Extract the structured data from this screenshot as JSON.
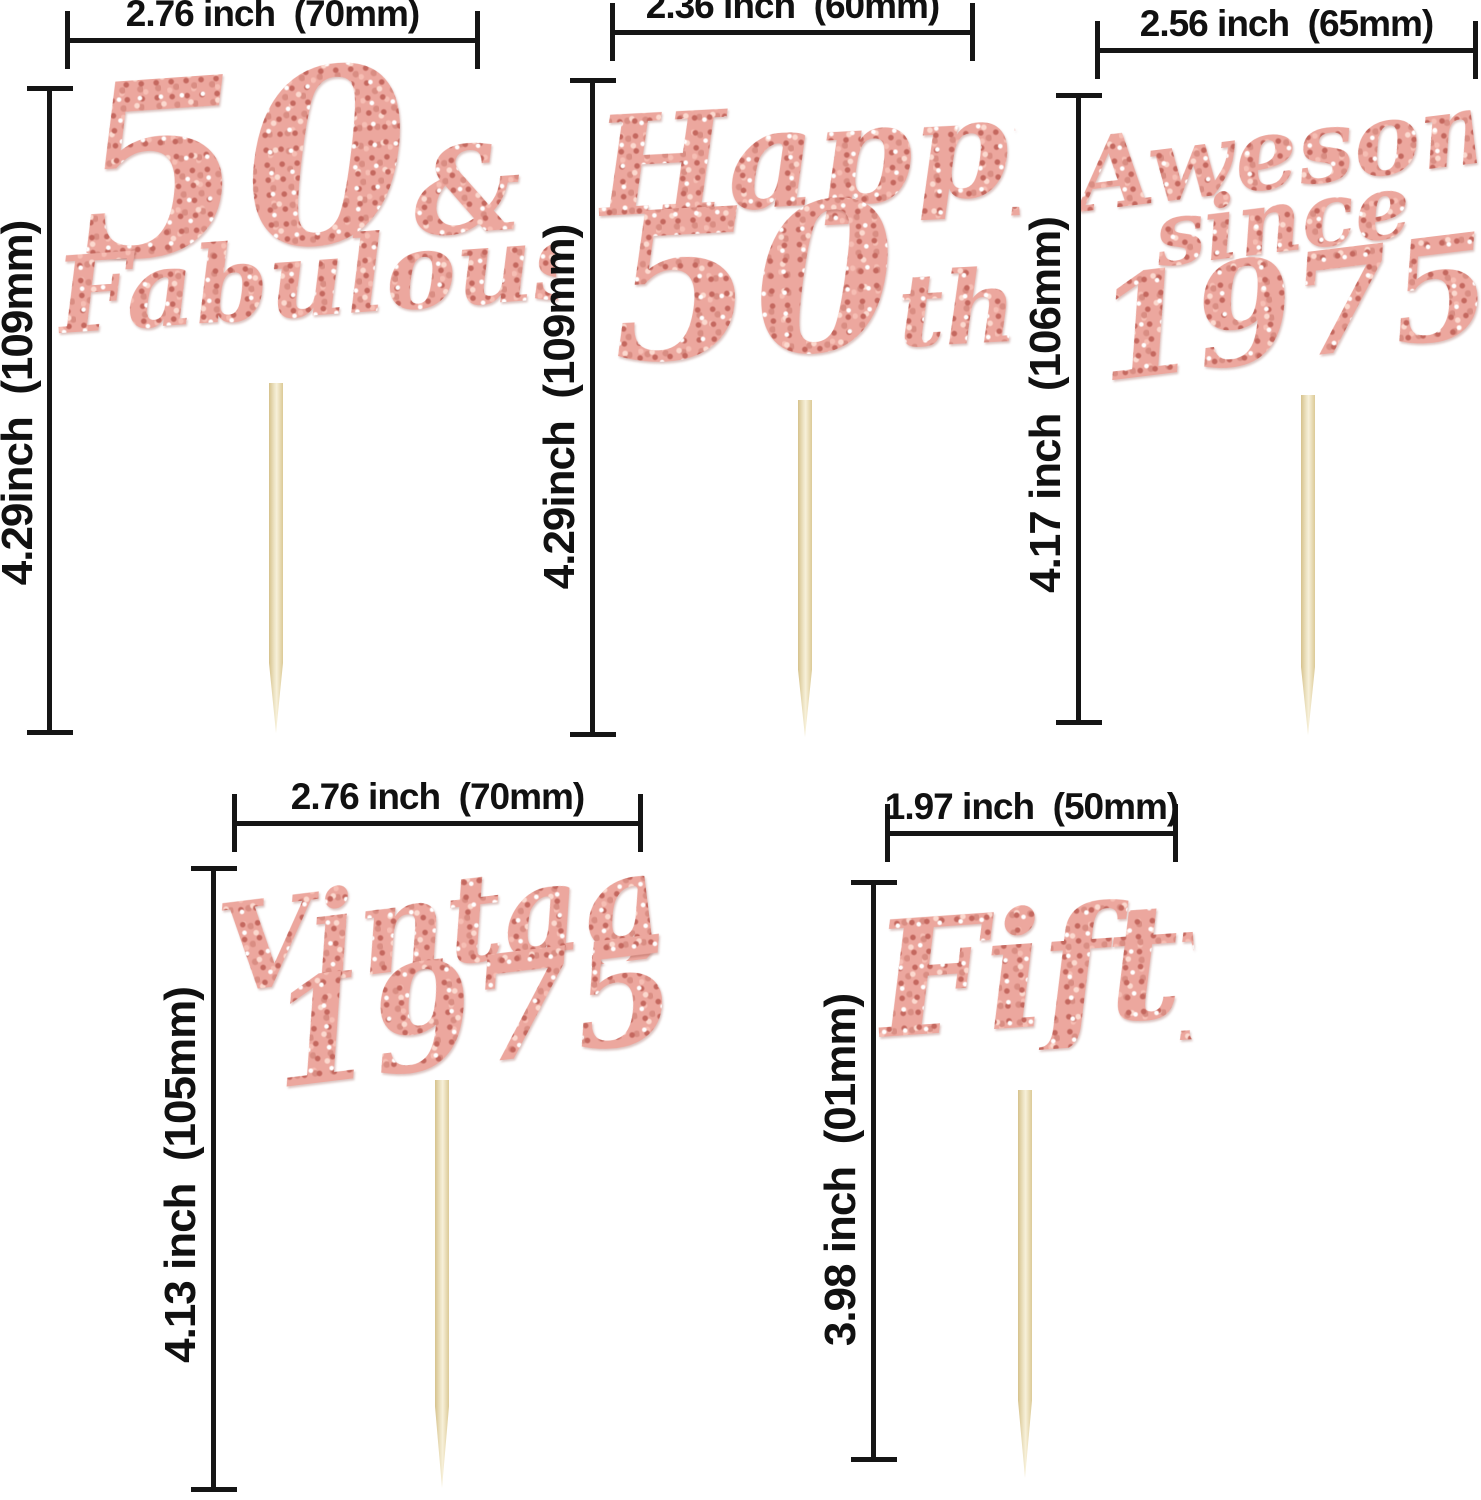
{
  "colors": {
    "glitter_rose_gold": "#E8A39A",
    "glitter_highlight": "#FBD9CF",
    "glitter_shadow": "#C4685F",
    "stick_wood": "#E9DBAB",
    "dimension_lines": "#151515",
    "background": "#FFFFFF"
  },
  "toppers": {
    "fiftyFab": {
      "num": "50",
      "amp": "&",
      "word": "Fabulous",
      "width_label": "2.76 inch  (70mm)",
      "height_label": "4.29inch  (109mm)"
    },
    "happy50": {
      "word": "Happy",
      "num": "50",
      "suffix": "th",
      "width_label": "2.36 inch  (60mm)",
      "height_label": "4.29inch  (109mm)"
    },
    "awesome": {
      "word1": "Awesome",
      "word2": "since",
      "word3": "1975",
      "width_label": "2.56 inch  (65mm)",
      "height_label": "4.17 inch  (106mm)"
    },
    "vintage": {
      "word1": "Vintage",
      "word2": "1975",
      "width_label": "2.76 inch  (70mm)",
      "height_label": "4.13 inch  (105mm)"
    },
    "fifty": {
      "word": "Fifty",
      "width_label": "1.97 inch  (50mm)",
      "height_label": "3.98 inch  (01mm)"
    }
  }
}
